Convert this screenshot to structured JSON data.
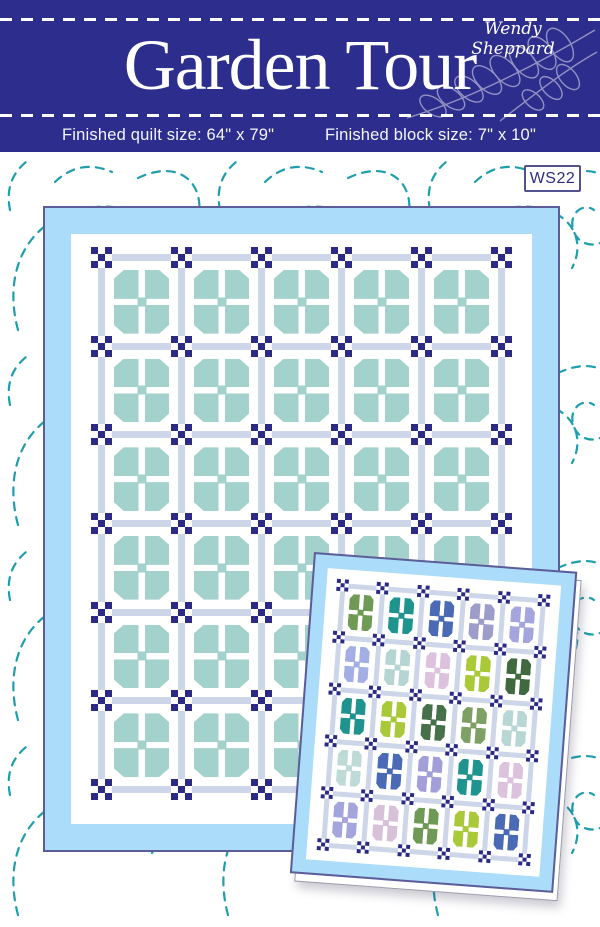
{
  "header": {
    "title": "Garden Tour",
    "designer": "Wendy Sheppard",
    "quilt_size_label": "Finished quilt size: 64\" x 79\"",
    "block_size_label": "Finished block size: 7\" x 10\"",
    "background_color": "#2d2d8d"
  },
  "badge": {
    "label": "WS22"
  },
  "background_pattern": {
    "style": "dashed quilting swirls",
    "color": "#1f9dac"
  },
  "main_quilt": {
    "columns": 5,
    "rows": 6,
    "block_color": "#a3d2cd",
    "border_color": "#abdcf9",
    "sashing_color": "#ccd6e8",
    "cornerstone_color": "#2b2b87",
    "outline_color": "#5c5c99"
  },
  "small_quilt": {
    "columns": 5,
    "rows": 5,
    "border_color": "#abdcf9",
    "sashing_color": "#ccd6e8",
    "cornerstone_color": "#2b2b87",
    "outline_color": "#5c5c99",
    "block_colors": [
      [
        "#6f9a55",
        "#1f948e",
        "#4b6ab5",
        "#9e9dca",
        "#a5a5de"
      ],
      [
        "#a2aee4",
        "#b4d5d1",
        "#dcc2dc",
        "#a9c938",
        "#41693f"
      ],
      [
        "#1f948e",
        "#a9c938",
        "#46704a",
        "#7fa065",
        "#b8d7d4"
      ],
      [
        "#bedad6",
        "#4b6ab5",
        "#a29fd8",
        "#1f948e",
        "#dcc2dc"
      ],
      [
        "#a5a5de",
        "#d6c1d9",
        "#6f9a55",
        "#a9c938",
        "#4b6ab5"
      ]
    ]
  }
}
